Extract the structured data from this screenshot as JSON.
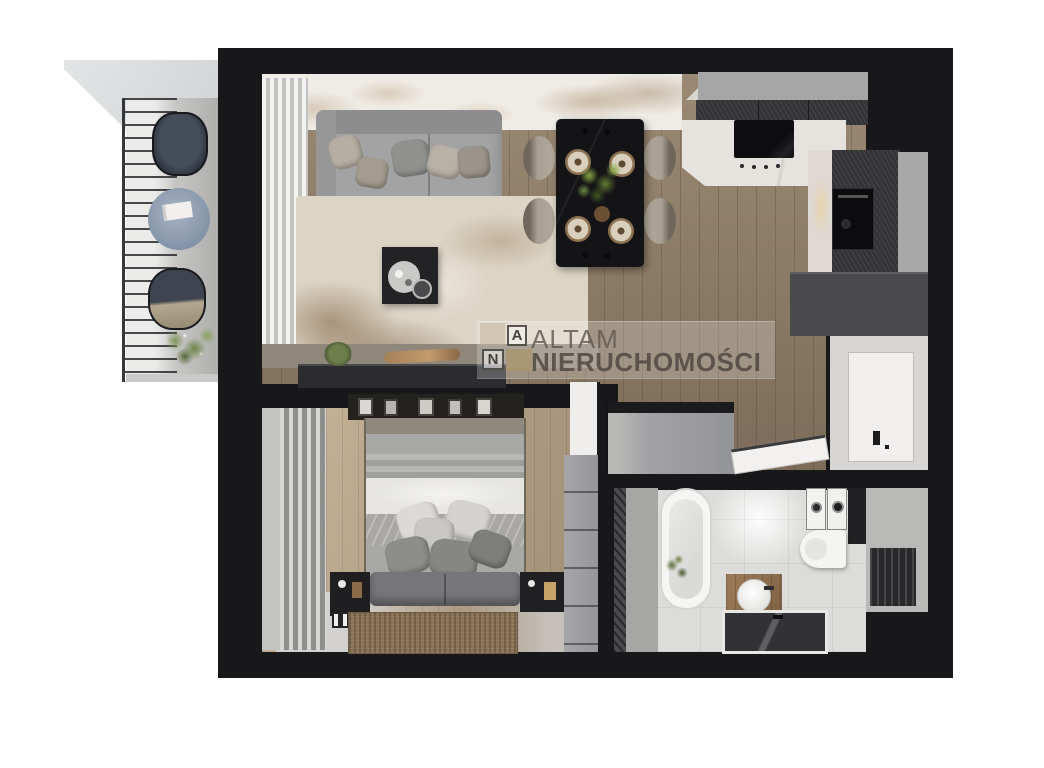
{
  "page": {
    "background": "#ffffff",
    "content_type": "apartment-floor-plan-3d-render"
  },
  "watermark": {
    "brand_line1": "ALTAM",
    "brand_line2": "NIERUCHOMOŚCI",
    "logo_letter_top": "A",
    "logo_letter_bottom": "N"
  },
  "palette": {
    "wall": "#18181a",
    "wood_floor": "#8d7c67",
    "bedroom_floor": "#b5a38a",
    "bathroom_floor": "#dcdcda",
    "balcony_stone": "#c6c6c4",
    "sofa": "#a3a3a3",
    "living_rug": "#dcd4c5",
    "bedroom_rug": "#8a7357",
    "dining_table": "#141417",
    "kitchen_cabinet": "#343436",
    "logo_accent_square": "#a8986e"
  }
}
